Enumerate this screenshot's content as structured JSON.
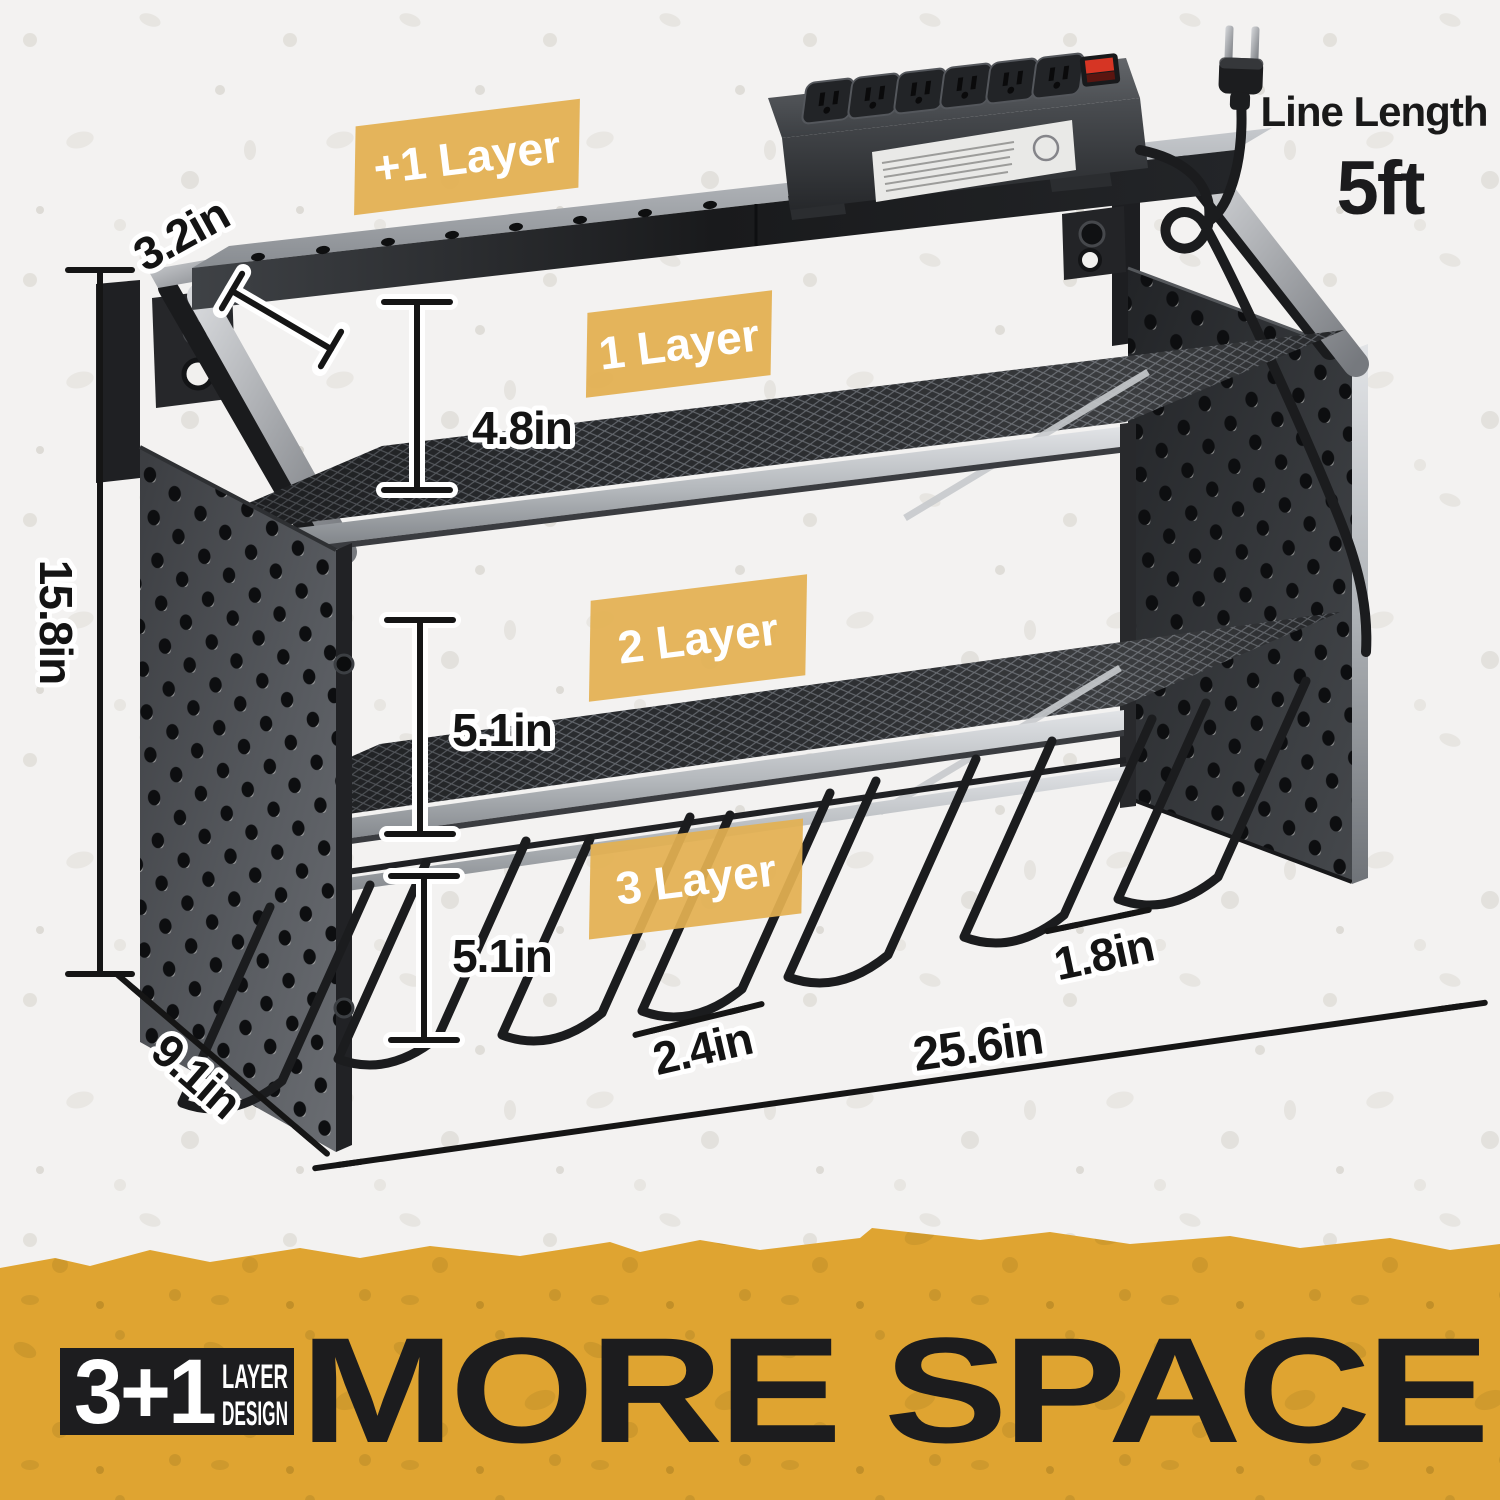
{
  "product_annotations": {
    "badges": [
      {
        "label": "+1 Layer"
      },
      {
        "label": "1 Layer"
      },
      {
        "label": "2 Layer"
      },
      {
        "label": "3 Layer"
      }
    ],
    "dimensions": {
      "top_depth": "3.2in",
      "layer1_height": "4.8in",
      "total_height": "15.8in",
      "layer2_height": "5.1in",
      "layer3_height": "5.1in",
      "hook_gap": "1.8in",
      "slot_width": "2.4in",
      "total_width": "25.6in",
      "total_depth": "9.1in"
    },
    "cord": {
      "label": "Line Length",
      "value": "5ft"
    }
  },
  "banner": {
    "stat": "3+1",
    "stat_caption_line1": "LAYER",
    "stat_caption_line2": "DESIGN",
    "headline": "MORE SPACE"
  },
  "colors": {
    "background": "#f3f2f1",
    "badge_yellow": "#e3b052",
    "banner_yellow": "#dfa431",
    "metal_dark": "#2b2d30",
    "text_black": "#1b1b1d",
    "switch_red": "#d63524"
  }
}
